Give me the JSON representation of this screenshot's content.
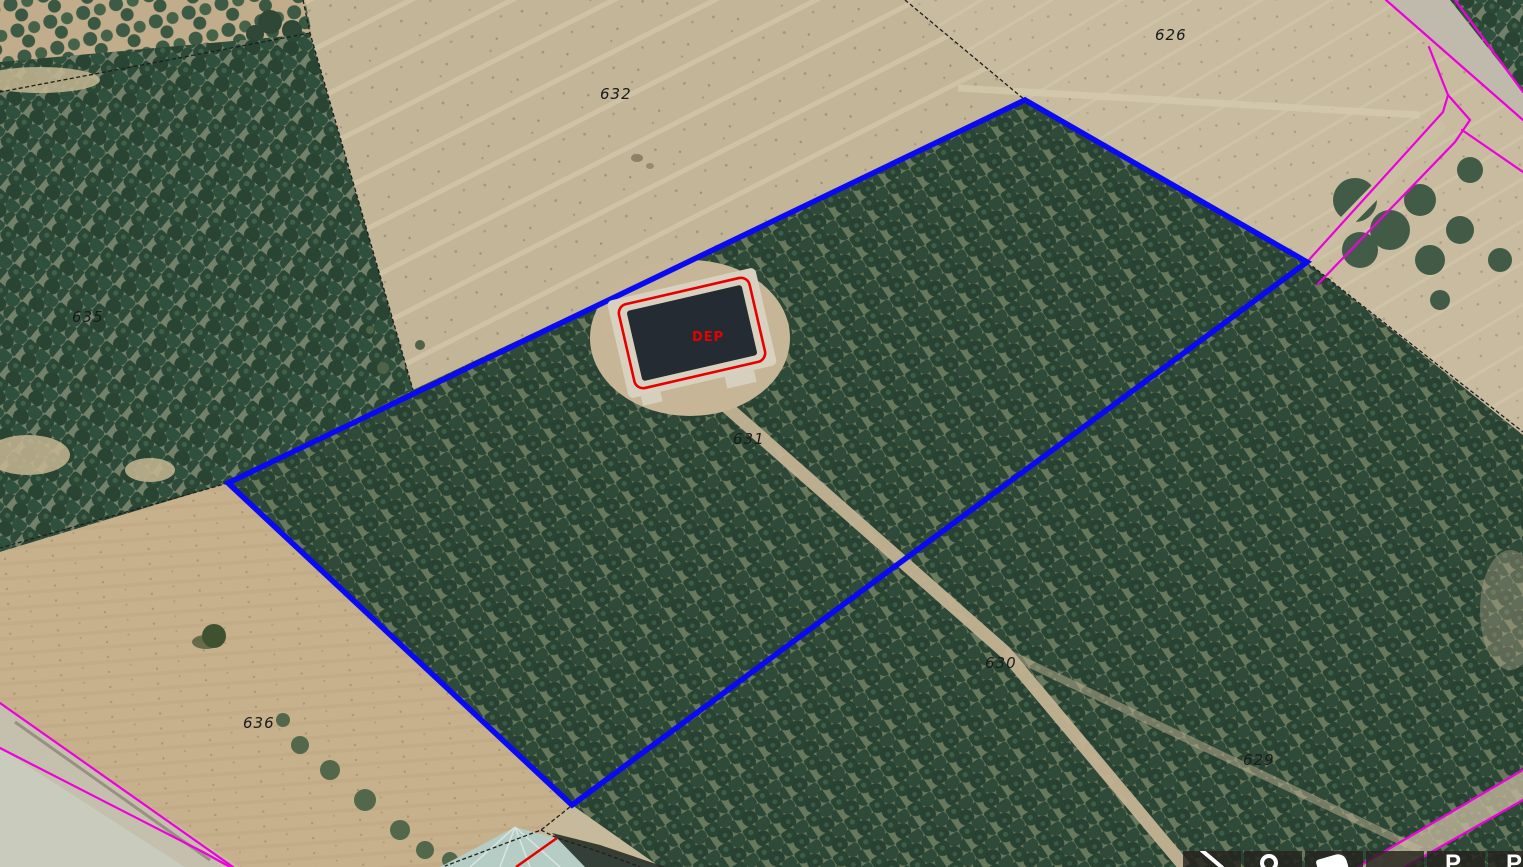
{
  "colors": {
    "selection_blue": "#0a0af2",
    "cadastral_magenta": "#ee00dd",
    "deposit_red": "#e60000",
    "label_black": "#1a1a1a"
  },
  "map": {
    "type": "aerial-orthophoto-cadastral-viewer",
    "parcels": [
      {
        "label": "626"
      },
      {
        "label": "632"
      },
      {
        "label": "635"
      },
      {
        "label": "636"
      },
      {
        "label": "631"
      },
      {
        "label": "630"
      },
      {
        "label": "629"
      }
    ],
    "deposit": {
      "label": "DEP"
    }
  },
  "toolbar": {
    "buttons": [
      {
        "icon": "diagonal-arrow"
      },
      {
        "icon": "magnifier-circle"
      },
      {
        "icon": "hand"
      },
      {
        "icon": "none"
      },
      {
        "icon": "letter",
        "glyph": "P"
      },
      {
        "icon": "letter",
        "glyph": "P"
      }
    ]
  }
}
